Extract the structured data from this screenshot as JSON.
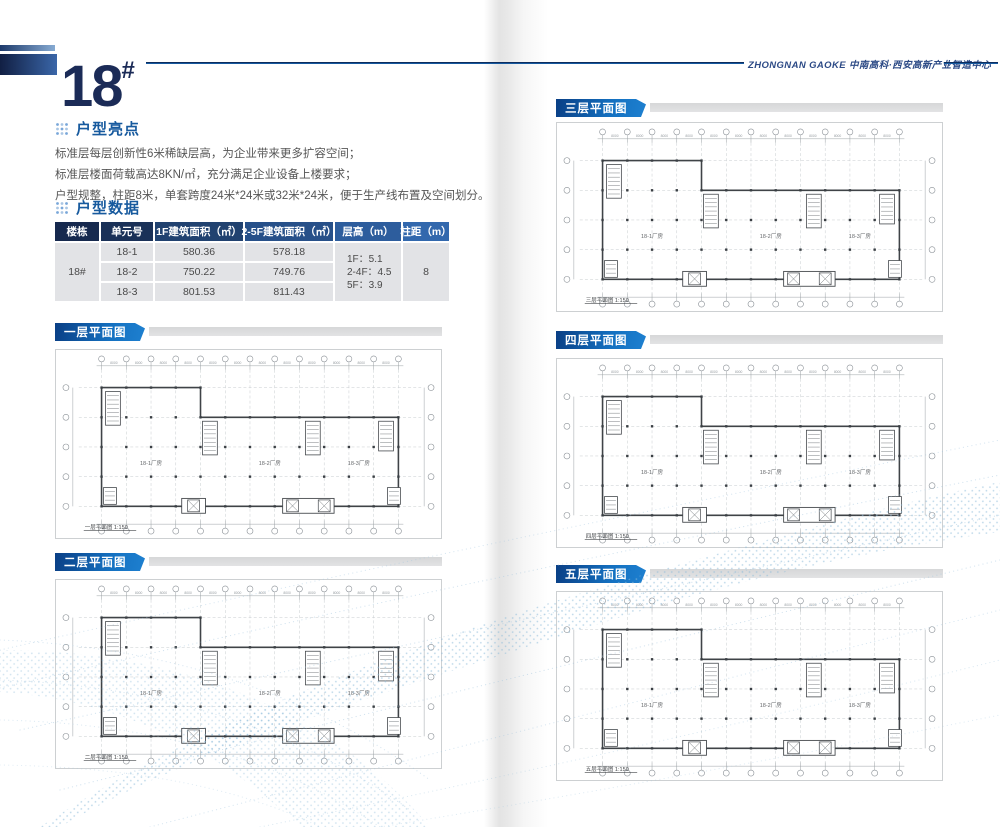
{
  "header": {
    "block_number": "18",
    "hash": "#",
    "brand_line": "ZHONGNAN GAOKE 中南高科·西安高新产业智造中心"
  },
  "highlights": {
    "title": "户型亮点",
    "lines": [
      "标准层每层创新性6米稀缺层高，为企业带来更多扩容空间；",
      "标准层楼面荷载高达8KN/㎡，充分满足企业设备上楼要求；",
      "户型规整，柱距8米，单套跨度24米*24米或32米*24米，便于生产线布置及空间划分。"
    ]
  },
  "data_table": {
    "title": "户型数据",
    "headers": [
      "楼栋",
      "单元号",
      "1F建筑面积（㎡）",
      "2-5F建筑面积（㎡）",
      "层高（m）",
      "柱距（m）"
    ],
    "building": "18#",
    "rows": [
      {
        "unit": "18-1",
        "area_1f": "580.36",
        "area_2_5f": "578.18"
      },
      {
        "unit": "18-2",
        "area_1f": "750.22",
        "area_2_5f": "749.76"
      },
      {
        "unit": "18-3",
        "area_1f": "801.53",
        "area_2_5f": "811.43"
      }
    ],
    "floor_heights": [
      "1F：5.1",
      "2-4F：4.5",
      "5F：3.9"
    ],
    "column_spacing": "8"
  },
  "plans": [
    {
      "label": "一层平面图",
      "caption": "一层平面图 1:150",
      "units": [
        "18-1厂房",
        "18-2厂房",
        "18-3厂房"
      ]
    },
    {
      "label": "二层平面图",
      "caption": "二层平面图 1:150",
      "units": [
        "18-1厂房",
        "18-2厂房",
        "18-3厂房"
      ]
    },
    {
      "label": "三层平面图",
      "caption": "三层平面图 1:150",
      "units": [
        "18-1厂房",
        "18-2厂房",
        "18-3厂房"
      ]
    },
    {
      "label": "四层平面图",
      "caption": "四层平面图 1:150",
      "units": [
        "18-1厂房",
        "18-2厂房",
        "18-3厂房"
      ]
    },
    {
      "label": "五层平面图",
      "caption": "五层平面图 1:150",
      "units": [
        "18-1厂房",
        "18-2厂房",
        "18-3厂房"
      ]
    }
  ],
  "plan_common": {
    "dim_label": "8000"
  }
}
